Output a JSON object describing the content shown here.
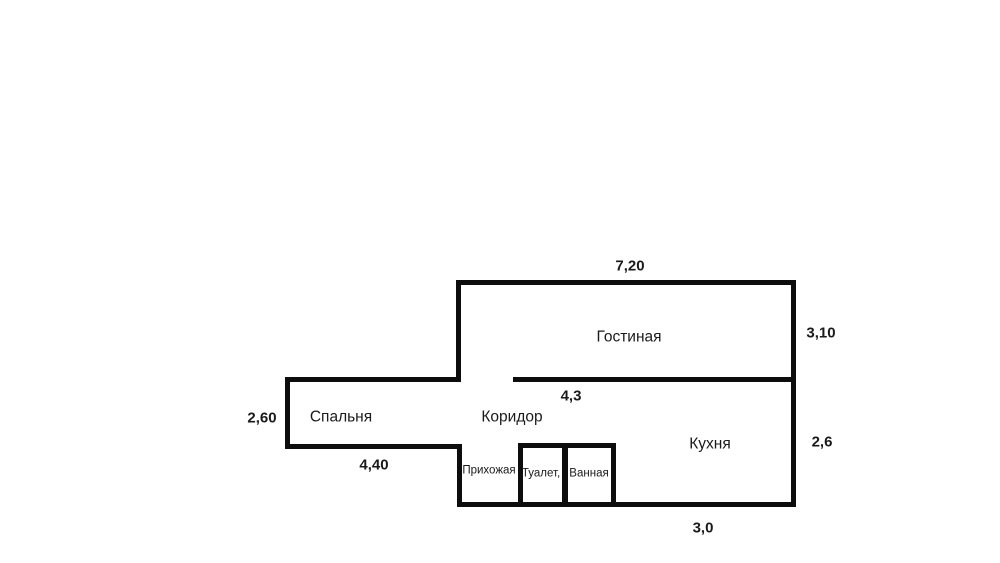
{
  "floorplan": {
    "type": "apartment-floor-plan",
    "language": "ru",
    "background_color": "#ffffff",
    "wall_color": "#0d0d0d",
    "text_color": "#1a1a1a",
    "rooms": [
      {
        "name": "living-room",
        "label": "Гостиная"
      },
      {
        "name": "bedroom",
        "label": "Спальня"
      },
      {
        "name": "corridor",
        "label": "Коридор"
      },
      {
        "name": "kitchen",
        "label": "Кухня"
      },
      {
        "name": "hallway",
        "label": "Прихожая"
      },
      {
        "name": "toilet",
        "label": "Туалет,"
      },
      {
        "name": "bathroom",
        "label": "Ванная"
      }
    ],
    "dimensions": [
      {
        "name": "living-room-width",
        "value": "7,20"
      },
      {
        "name": "living-room-depth",
        "value": "3,10"
      },
      {
        "name": "corridor-length",
        "value": "4,3"
      },
      {
        "name": "bedroom-depth",
        "value": "2,60"
      },
      {
        "name": "bedroom-width",
        "value": "4,40"
      },
      {
        "name": "kitchen-depth",
        "value": "2,6"
      },
      {
        "name": "kitchen-width",
        "value": "3,0"
      }
    ]
  }
}
